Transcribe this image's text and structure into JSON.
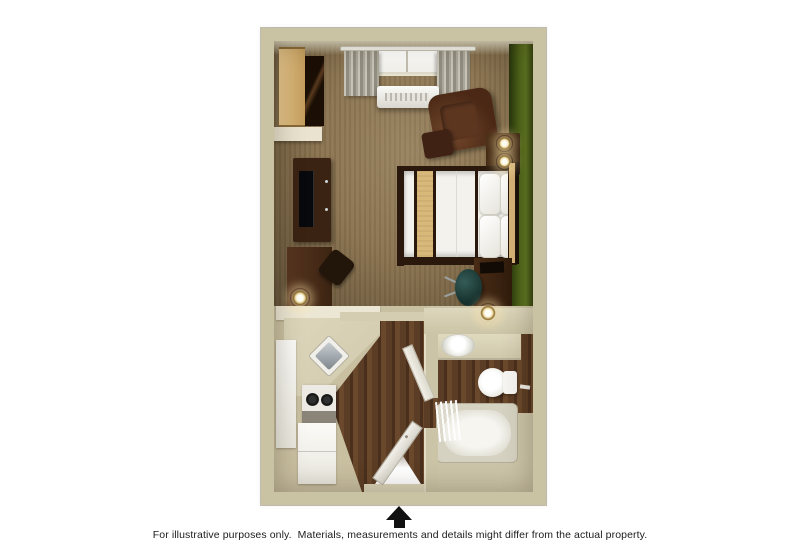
{
  "caption": {
    "text": "For illustrative purposes only.  Materials, measurements and details might differ from the actual property."
  },
  "entrance_marker": {
    "icon": "arrow-up"
  },
  "rooms": [
    "bedroom-living-area",
    "kitchenette",
    "entry-hall",
    "bathroom"
  ],
  "furniture": [
    "window-with-curtains",
    "ptac-ac-unit",
    "closet-shelves",
    "tv-console",
    "television",
    "writing-desk",
    "desk-chair",
    "armchair",
    "ottoman",
    "side-table",
    "table-lamps",
    "bed",
    "pillows",
    "bed-runner",
    "headboard",
    "nightstand-desk",
    "office-chair",
    "kitchen-counter",
    "kitchen-sink",
    "stove-cooktop",
    "refrigerator",
    "tall-cabinet",
    "entry-door",
    "bathroom-door",
    "bathroom-vanity",
    "vanity-sink",
    "toilet",
    "bathtub",
    "shower-curtain",
    "towel-bar"
  ],
  "palette": {
    "wall": "#c9c2a3",
    "wall_light": "#dad4bc",
    "carpet": "#8b7450",
    "wood": "#5b3c24",
    "wood_dark": "#4a2f1d",
    "green_accent": "#4f6519",
    "fixture_white": "#f4f3ee",
    "furniture_dark": "#3a2313",
    "wood_tan": "#d4b277",
    "linen": "#f3f2ed",
    "runner_tan": "#d9b97a",
    "glow": "#ffe9b0",
    "floor_beige": "#c9bfa1",
    "arrow": "#111111"
  }
}
